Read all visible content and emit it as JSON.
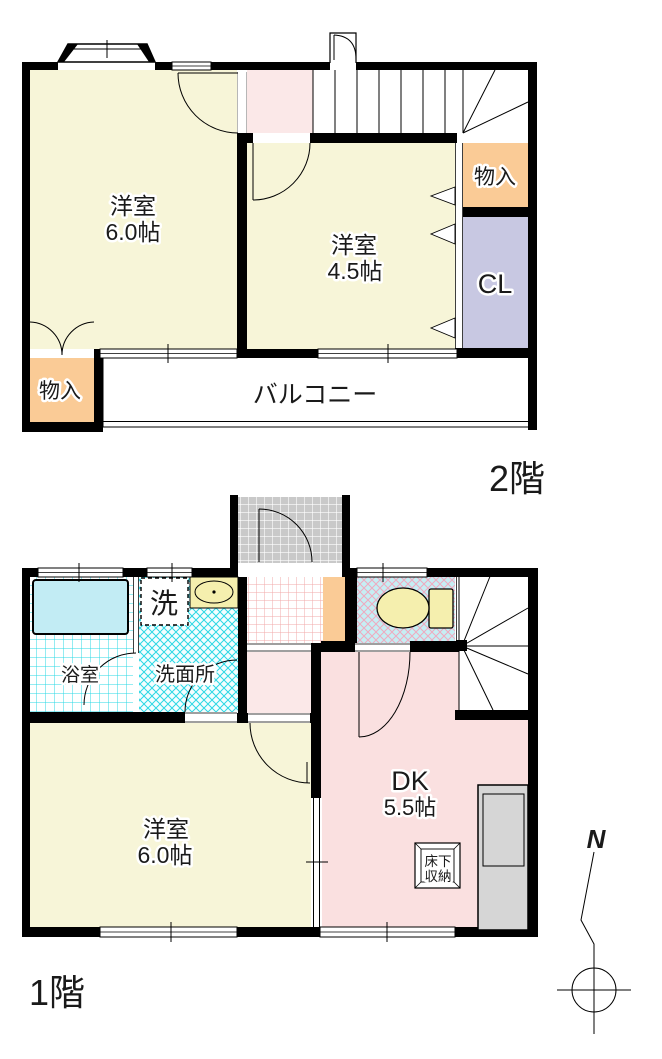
{
  "f2": {
    "floor_label": "2階",
    "room6": {
      "name": "洋室",
      "size": "6.0帖"
    },
    "room45": {
      "name": "洋室",
      "size": "4.5帖"
    },
    "storage_right": {
      "label": "物入"
    },
    "closet": {
      "label": "CL"
    },
    "storage_left": {
      "label": "物入"
    },
    "balcony": {
      "label": "バルコニー"
    }
  },
  "f1": {
    "floor_label": "1階",
    "bathroom": {
      "label": "浴室"
    },
    "washer": {
      "label": "洗"
    },
    "washroom": {
      "label": "洗面所"
    },
    "room6": {
      "name": "洋室",
      "size": "6.0帖"
    },
    "dk": {
      "name": "DK",
      "size": "5.5帖"
    },
    "floor_storage": {
      "line1": "床下",
      "line2": "収納"
    }
  },
  "compass": {
    "label": "N"
  },
  "colors": {
    "room_cream": "#F7F5D8",
    "hall_pink": "#FBE8E8",
    "dk_pink": "#FAE0E0",
    "storage_orange": "#FACB96",
    "closet_lavender": "#C8C8E2",
    "water_cyan": "#C2ECF4",
    "porch_gray": "#C9C9C9",
    "kitchen_gray": "#D6D6D6",
    "wall_black": "#000000"
  }
}
